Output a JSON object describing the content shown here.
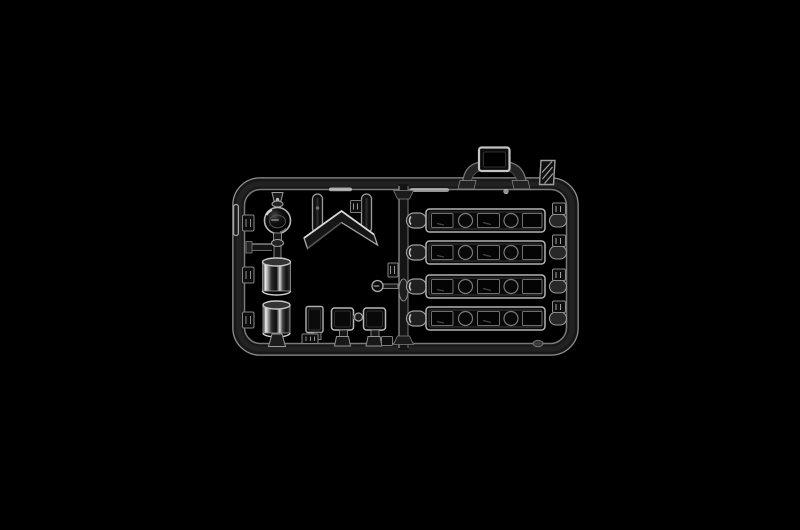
{
  "scene": {
    "type": "product-photo",
    "subject": "clear-plastic-model-kit-sprue",
    "description": "Transparent injection-molded clear-parts runner (windows and lenses) photographed on a black background"
  },
  "colors": {
    "background": "#000000",
    "rail_body": "#181818",
    "rail_sheen": "#262626",
    "edge_outer": "#9f9f9f",
    "edge_inner": "#8c8c8c",
    "part_fill": "#0a0a0a",
    "part_stroke": "#b2b2b2",
    "window_fill": "#040404",
    "window_stroke": "#6f6f6f",
    "tab_fill": "#0e0e0e",
    "tab_stroke": "#8a8a8a",
    "glint": "#e0e0e0"
  },
  "sprue": {
    "frame": {
      "name": "runner-frame",
      "shape": "rounded-rectangle"
    },
    "window_strips": {
      "count": 4,
      "y_centers": [
        220.5,
        252.5,
        286.5,
        318.5
      ],
      "pattern": [
        "window",
        "porthole",
        "window",
        "porthole",
        "window"
      ]
    },
    "left_rail_tabs": {
      "count": 3,
      "y_centers": [
        223,
        275,
        320
      ]
    },
    "parts": [
      {
        "id": "dome-lens",
        "kind": "round clear lens"
      },
      {
        "id": "lens-neck-joint",
        "kind": "cross joint"
      },
      {
        "id": "cylinder-lens-upper",
        "kind": "clear cylinder"
      },
      {
        "id": "cylinder-lens-lower",
        "kind": "clear cylinder"
      },
      {
        "id": "chevron-windscreen",
        "kind": "v-shaped clear panel"
      },
      {
        "id": "runner-drop-left",
        "kind": "runner stub"
      },
      {
        "id": "runner-drop-right",
        "kind": "runner stub"
      },
      {
        "id": "roof-hatch-window",
        "kind": "rectangular clear pane"
      },
      {
        "id": "grab-handle",
        "kind": "curved handle"
      },
      {
        "id": "hatched-label-tab",
        "kind": "molded tab"
      },
      {
        "id": "door-window-vertical",
        "kind": "rectangular clear pane"
      },
      {
        "id": "side-window-left",
        "kind": "rectangular clear pane"
      },
      {
        "id": "side-window-right",
        "kind": "rectangular clear pane"
      },
      {
        "id": "link-knob",
        "kind": "round knob"
      },
      {
        "id": "small-round-lens",
        "kind": "lens on stem"
      },
      {
        "id": "glazing-strip",
        "kind": "five-light window strip",
        "count": 4
      }
    ]
  }
}
